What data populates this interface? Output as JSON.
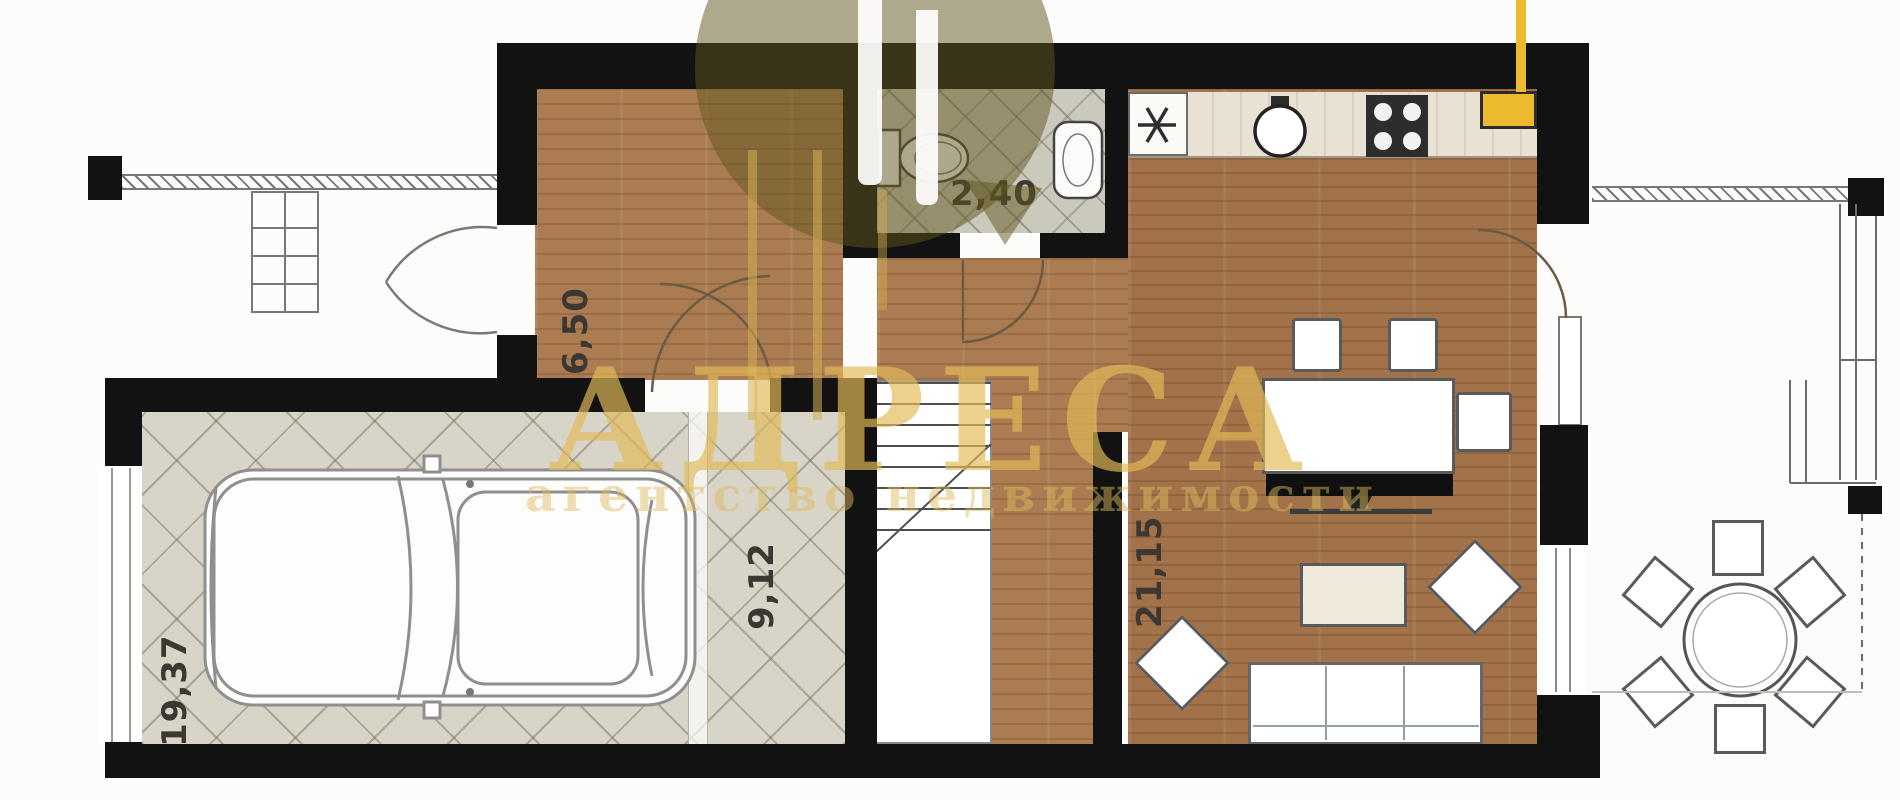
{
  "plan": {
    "type": "apartment-floor-plan",
    "rooms": [
      {
        "id": "garage",
        "area_label": "19,37"
      },
      {
        "id": "entry-hall",
        "area_label": "6,50"
      },
      {
        "id": "bathroom",
        "area_label": "2,40"
      },
      {
        "id": "stair-hall",
        "area_label": "9,12"
      },
      {
        "id": "living-kitchen",
        "area_label": "21,15"
      }
    ]
  },
  "watermark": {
    "brand": "АДРЕСА",
    "tagline": "агентство недвижимости",
    "brand_color": "#e2ba58",
    "logo_color": "#5f551e"
  },
  "icons": {
    "fridge": "snowflake-asterisk",
    "kitchen_sink": "round-basin",
    "stove": "four-burner-cooktop",
    "toilet": "toilet-top-view",
    "washbasin": "oval-basin",
    "boiler": "yellow-water-heater",
    "car": "car-top-view",
    "stairs": "stair-flight"
  },
  "colors": {
    "wall": "#121212",
    "wood_floor": "#ab7c52",
    "garage_tile": "#d8d4c7",
    "bath_tile": "#cbc8bc",
    "boiler_yellow": "#edb92e"
  }
}
